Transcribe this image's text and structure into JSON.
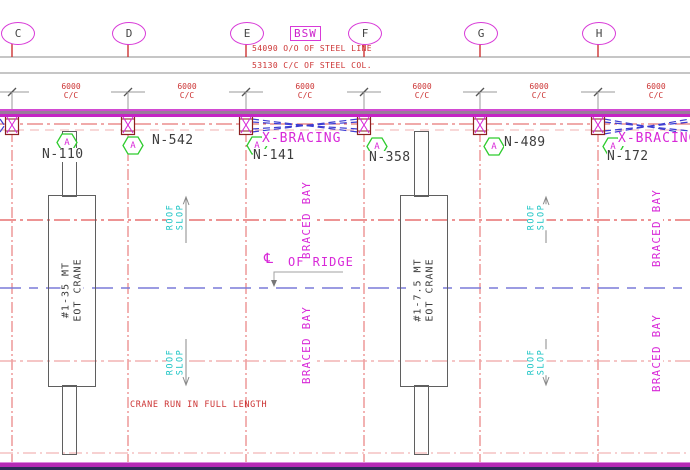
{
  "header": {
    "bsw": "BSW"
  },
  "grids": {
    "bubbles": [
      "C",
      "D",
      "E",
      "F",
      "G",
      "H"
    ]
  },
  "overall_dims": {
    "line1": "54090 O/O OF STEEL LINE",
    "line2": "53130 C/C OF STEEL COL."
  },
  "bays": [
    {
      "dim": "6000",
      "unit": "C/C"
    },
    {
      "dim": "6000",
      "unit": "C/C"
    },
    {
      "dim": "6000",
      "unit": "C/C"
    },
    {
      "dim": "6000",
      "unit": "C/C"
    },
    {
      "dim": "6000",
      "unit": "C/C"
    },
    {
      "dim": "6000",
      "unit": "C/C"
    }
  ],
  "columns": [
    {
      "badge": "A",
      "mark": "N-110"
    },
    {
      "badge": "A",
      "mark": "N-542"
    },
    {
      "badge": "A",
      "mark": "N-141"
    },
    {
      "badge": "A",
      "mark": "N-358"
    },
    {
      "badge": "A",
      "mark": "N-489"
    },
    {
      "badge": "A",
      "mark": "N-172"
    }
  ],
  "bracing": {
    "left": "X-BRACING",
    "right": "X-BRACING"
  },
  "roof_slope": {
    "word1": "ROOF",
    "word2": "SLOP"
  },
  "labels": {
    "braced_bay": "BRACED BAY"
  },
  "ridge": {
    "symbol": "℄",
    "label": "OF RIDGE"
  },
  "cranes": [
    {
      "line1": "#1-35 MT",
      "line2": "EOT CRANE"
    },
    {
      "line1": "#1-7.5 MT",
      "line2": "EOT CRANE"
    }
  ],
  "notes": {
    "crane_run": "CRANE RUN IN FULL LENGTH"
  },
  "colors": {
    "magenta": "#d828d8",
    "cyan": "#17c3c3",
    "red": "#cc3333",
    "grid_red": "#e25555",
    "bracing_blue": "#3d3dd2",
    "ridge_blue": "#7a7ad8",
    "badge_green": "#2ecc2e",
    "column_maroon": "#8b2020",
    "band_purple": "#9a7b9a",
    "navy_band": "#2b2b57"
  }
}
